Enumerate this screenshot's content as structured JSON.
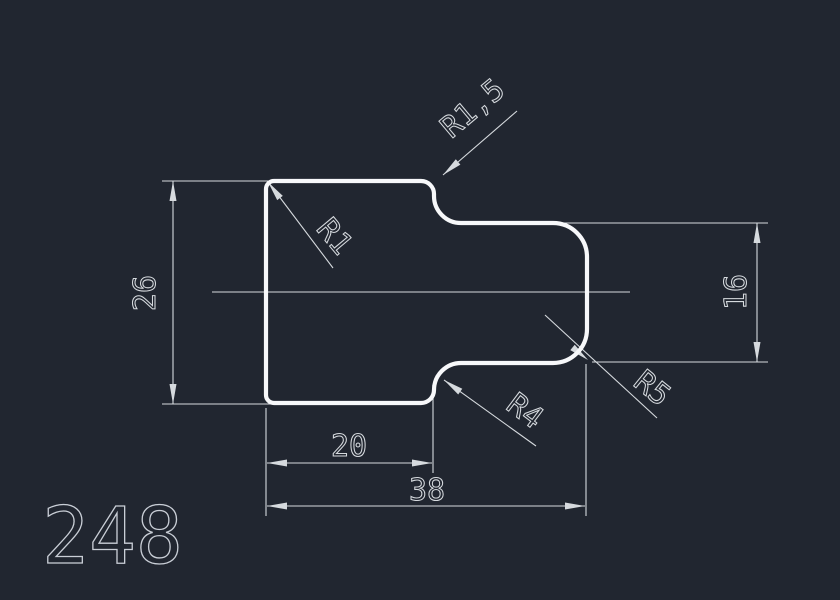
{
  "drawing": {
    "part_number": "248",
    "colors": {
      "background": "#212630",
      "outline": "#f7f8fa",
      "dimension": "#d6dade"
    },
    "dimensions": {
      "left_height": "26",
      "right_height": "16",
      "inner_width": "20",
      "outer_width": "38"
    },
    "radius_labels": {
      "top_left_corner": "R1",
      "top_step_fillet": "R1,5",
      "bottom_step_fillet": "R4",
      "right_corners": "R5"
    }
  }
}
